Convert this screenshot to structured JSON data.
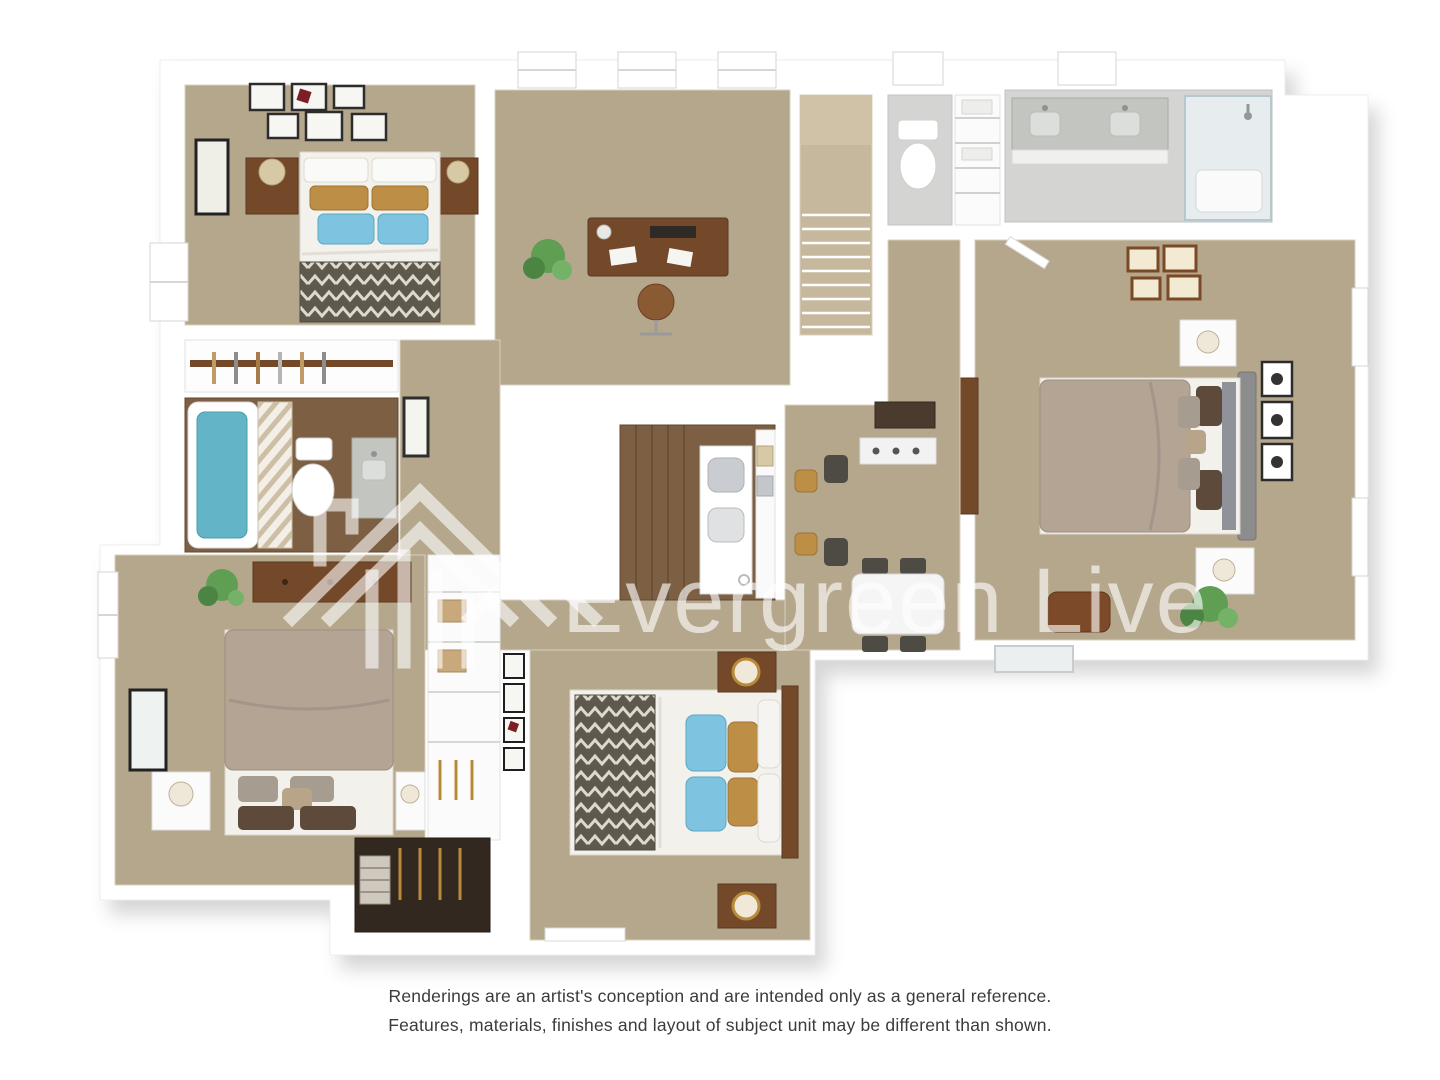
{
  "watermark": {
    "brand": "Evergreen Live"
  },
  "disclaimer": {
    "line1": "Renderings are an artist's conception and are intended only as a general reference.",
    "line2": "Features, materials, finishes and layout of subject unit may be different than shown."
  },
  "palette": {
    "carpet": "#b5a78c",
    "carpet_light": "#c6b89d",
    "wood_floor": "#7d5f43",
    "furniture_wood": "#74492a",
    "bed_white": "#f3f1ec",
    "duvet_taupe": "#b3a494",
    "headboard_gray": "#8c8c8c",
    "pillow_blue": "#7ec4e0",
    "pillow_tan": "#bd8e45",
    "pillow_brown": "#5d4a3a",
    "pillow_pattern_gray": "#a79c90",
    "chevron_dark": "#5f594d",
    "tile_gray": "#d4d5d3",
    "granite": "#c3c6c0",
    "water_blue": "#62b4c6",
    "plant_green": "#5f9e53",
    "wall_white": "#ffffff",
    "disclaimer_text": "#3b3b3b",
    "watermark_white": "rgba(255,255,255,0.62)"
  }
}
